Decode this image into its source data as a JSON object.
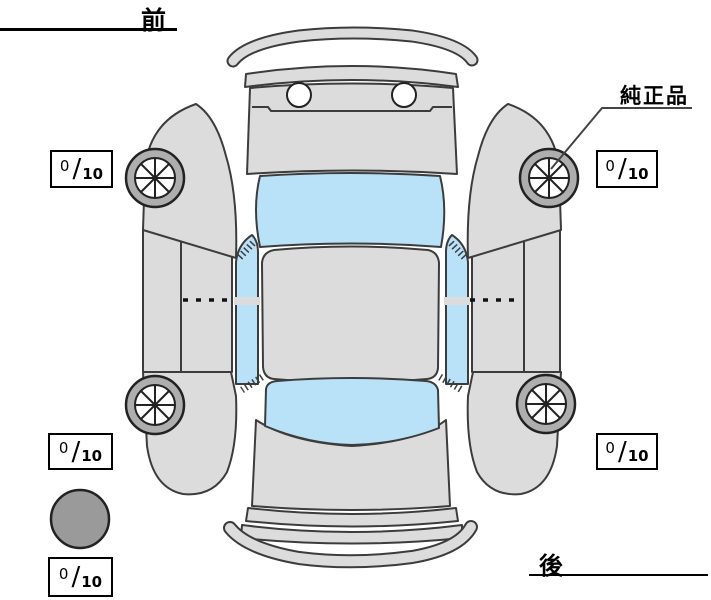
{
  "diagram": {
    "type": "vehicle-inspection-top-view",
    "front_label": "前",
    "rear_label": "後",
    "genuine_parts_label": "純正品",
    "fraction_separator": "/",
    "tread_depths": {
      "front_left": {
        "value": "0",
        "max": "10"
      },
      "front_right": {
        "value": "0",
        "max": "10"
      },
      "rear_left": {
        "value": "0",
        "max": "10"
      },
      "rear_right": {
        "value": "0",
        "max": "10"
      },
      "spare": {
        "value": "0",
        "max": "10"
      }
    }
  },
  "colors": {
    "background": "#ffffff",
    "body": "#dcdcdc",
    "outline": "#3c3c3c",
    "glass": "#b9e1f8",
    "tire": "#aeaeae",
    "hub": "#ffffff",
    "spare": "#9a9a9a",
    "box-border": "#000000",
    "text": "#000000"
  }
}
